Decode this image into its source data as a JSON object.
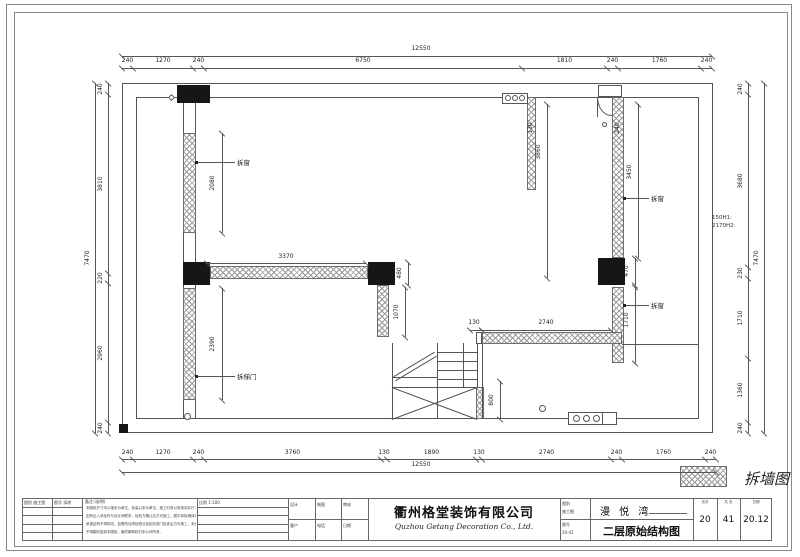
{
  "legend": {
    "label": "拆墙图"
  },
  "dimensions": {
    "top_total": "12550",
    "top_chain": [
      "240",
      "1270",
      "240",
      "6750",
      "1810",
      "240",
      "1760",
      "240"
    ],
    "bottom_chain": [
      "240",
      "1270",
      "240",
      "3760",
      "130",
      "1890",
      "130",
      "2740",
      "240",
      "1760",
      "240"
    ],
    "bottom_total": "12550",
    "left_chain": [
      "240",
      "3810",
      "220",
      "2960",
      "240"
    ],
    "left_total": "7470",
    "right_chain": [
      "240",
      "3680",
      "230",
      "1710",
      "1360",
      "240"
    ],
    "right_total": "7470",
    "interior": [
      "2080",
      "2390",
      "3370",
      "480",
      "1070",
      "130",
      "3860",
      "240",
      "3450",
      "470",
      "1710",
      "130",
      "2740",
      "800"
    ],
    "height_note": "150H1:\n2170H2:"
  },
  "annotations": {
    "demolish_window": "拆窗",
    "demolish_stair_door": "拆梯门"
  },
  "title_block": {
    "cell_type": "图别 施工图",
    "cell_no": "图号 拆除",
    "notes_title": "备注:(说明)",
    "notes_lines": [
      "本图纸尺寸均以毫米为单位，标高以米为单位，施工时请以现场实际尺寸为准，",
      "如有出入请及时与设计师联系，经双方确认后方可施工。图中拆除墙体均为非承重墙，",
      "承重结构不得拆改，如需改动须经物业及相关部门批准后方可施工，未经许可",
      "不得翻印复制本图纸，最终解释权归本公司所有。"
    ],
    "cell_scale": "比例 1:100",
    "grid_row1": [
      "设计",
      "制图",
      "审核"
    ],
    "grid_row2": [
      "客户",
      "电话",
      "日期"
    ],
    "company_cn": "衢州格堂装饰有限公司",
    "company_en": "Quzhou Getang Decoration Co., Ltd.",
    "side_top": [
      "图别",
      "施工图"
    ],
    "side_bottom": [
      "图号",
      "20-41"
    ],
    "project_name": "漫 悦 湾",
    "drawing_title": "二层原始结构图",
    "pages": [
      {
        "header": "页次",
        "value": "20"
      },
      {
        "header": "共 页",
        "value": "41"
      },
      {
        "header": "日期",
        "value": "20.12"
      }
    ]
  }
}
